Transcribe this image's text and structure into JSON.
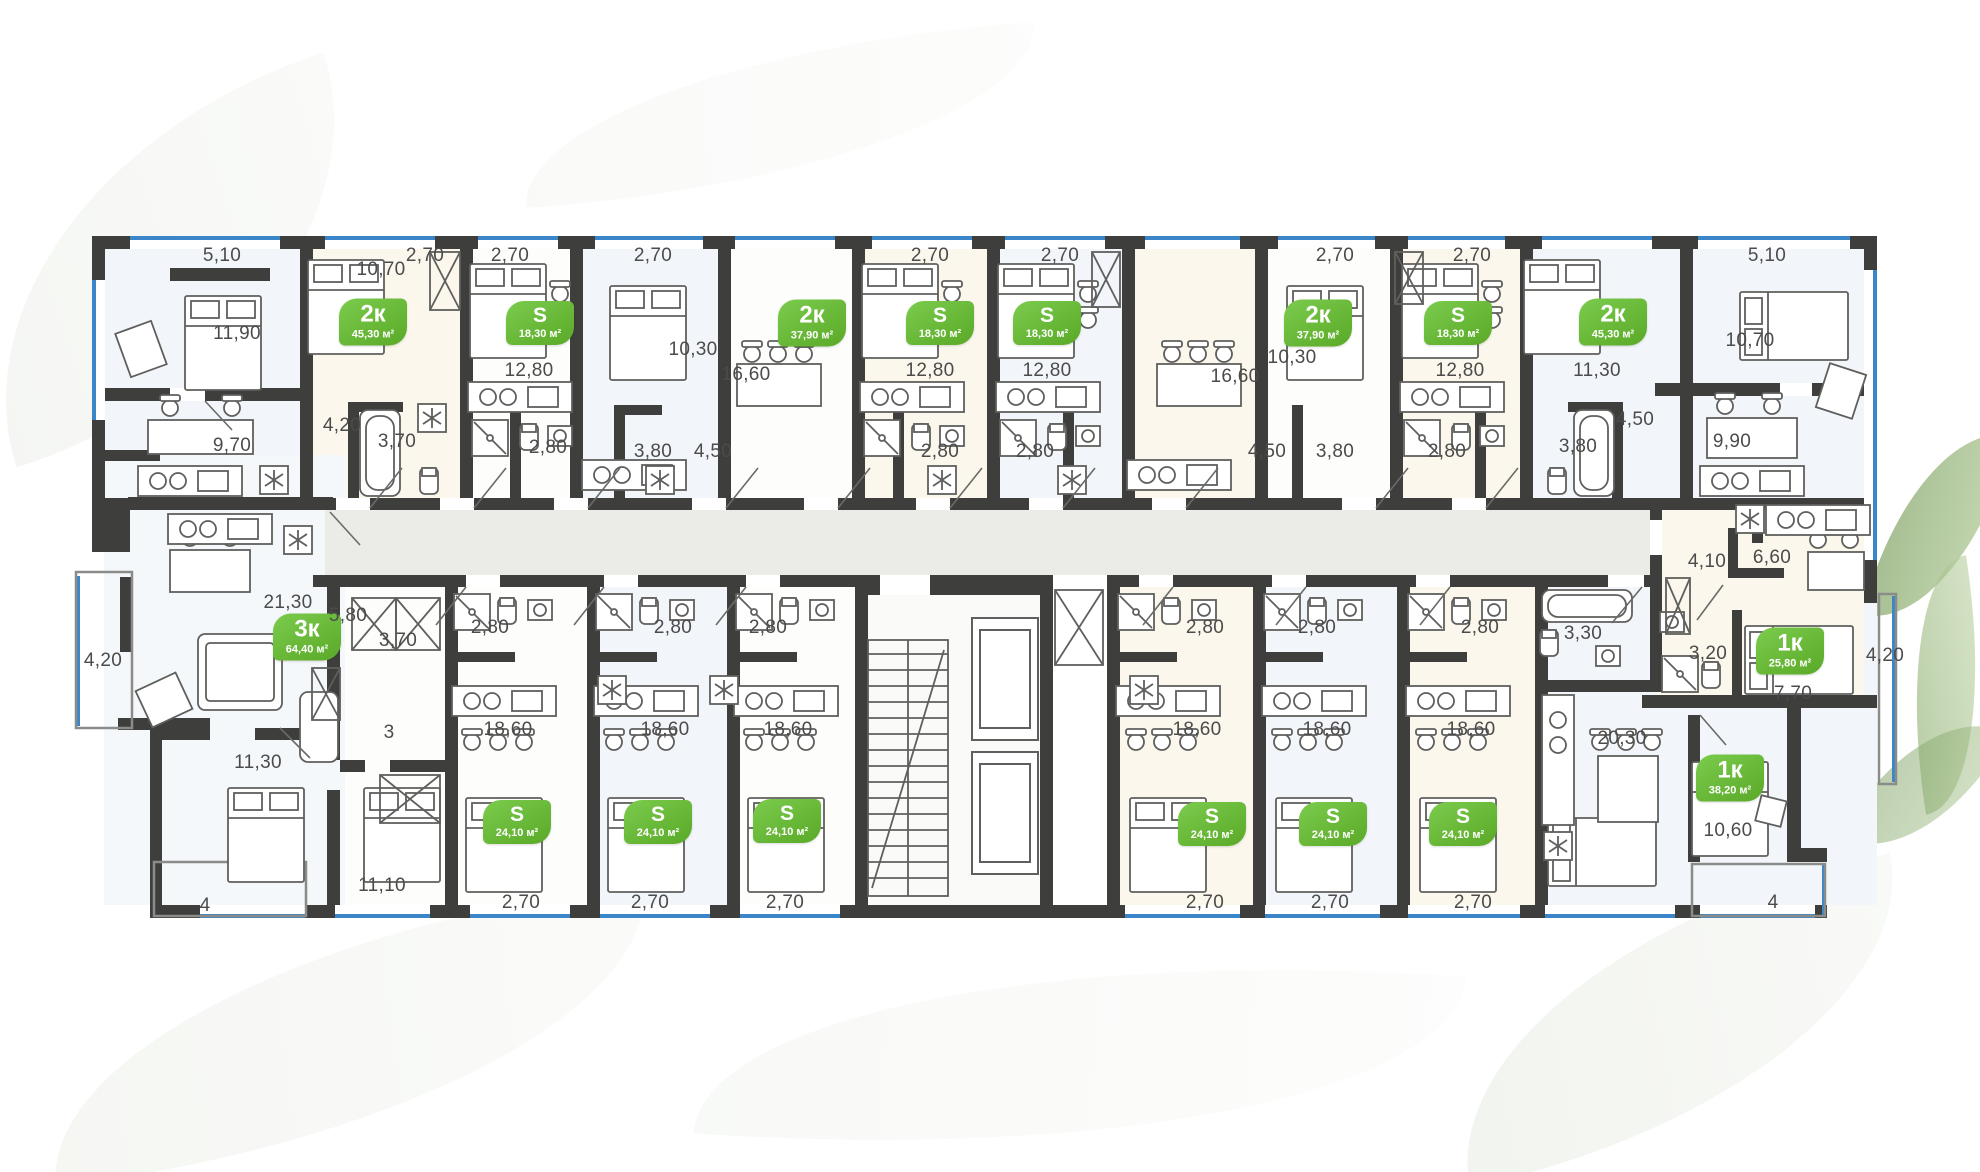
{
  "plan_title": "residential-building-floor-plan",
  "colors": {
    "badge_green": "#66bb39",
    "wall_dark": "#3e3e3c",
    "window_blue": "#3a86c8",
    "corridor_gray": "#ebebe7",
    "dim_text": "#4b4b4b"
  },
  "badges": [
    {
      "type": "2к",
      "area": "45,30 м²",
      "x": 373,
      "y": 322,
      "size": "l"
    },
    {
      "type": "S",
      "area": "18,30 м²",
      "x": 540,
      "y": 323,
      "size": "s"
    },
    {
      "type": "2к",
      "area": "37,90 м²",
      "x": 812,
      "y": 323,
      "size": "l"
    },
    {
      "type": "S",
      "area": "18,30 м²",
      "x": 940,
      "y": 323,
      "size": "s"
    },
    {
      "type": "S",
      "area": "18,30 м²",
      "x": 1047,
      "y": 323,
      "size": "s"
    },
    {
      "type": "2к",
      "area": "37,90 м²",
      "x": 1318,
      "y": 323,
      "size": "l"
    },
    {
      "type": "S",
      "area": "18,30 м²",
      "x": 1458,
      "y": 323,
      "size": "s"
    },
    {
      "type": "2к",
      "area": "45,30 м²",
      "x": 1613,
      "y": 322,
      "size": "l"
    },
    {
      "type": "3к",
      "area": "64,40 м²",
      "x": 307,
      "y": 637,
      "size": "l"
    },
    {
      "type": "1к",
      "area": "25,80 м²",
      "x": 1790,
      "y": 651,
      "size": "l"
    },
    {
      "type": "1к",
      "area": "38,20 м²",
      "x": 1730,
      "y": 778,
      "size": "l"
    },
    {
      "type": "S",
      "area": "24,10 м²",
      "x": 517,
      "y": 822,
      "size": "s"
    },
    {
      "type": "S",
      "area": "24,10 м²",
      "x": 658,
      "y": 822,
      "size": "s"
    },
    {
      "type": "S",
      "area": "24,10 м²",
      "x": 787,
      "y": 821,
      "size": "s"
    },
    {
      "type": "S",
      "area": "24,10 м²",
      "x": 1212,
      "y": 824,
      "size": "s"
    },
    {
      "type": "S",
      "area": "24,10 м²",
      "x": 1333,
      "y": 824,
      "size": "s"
    },
    {
      "type": "S",
      "area": "24,10 м²",
      "x": 1463,
      "y": 824,
      "size": "s"
    }
  ],
  "dimensions": [
    {
      "t": "5,10",
      "x": 222,
      "y": 256
    },
    {
      "t": "2,70",
      "x": 425,
      "y": 256
    },
    {
      "t": "2,70",
      "x": 510,
      "y": 256
    },
    {
      "t": "2,70",
      "x": 653,
      "y": 256
    },
    {
      "t": "2,70",
      "x": 930,
      "y": 256
    },
    {
      "t": "2,70",
      "x": 1060,
      "y": 256
    },
    {
      "t": "2,70",
      "x": 1335,
      "y": 256
    },
    {
      "t": "2,70",
      "x": 1472,
      "y": 256
    },
    {
      "t": "5,10",
      "x": 1767,
      "y": 256
    },
    {
      "t": "10,70",
      "x": 381,
      "y": 270
    },
    {
      "t": "11,90",
      "x": 237,
      "y": 334
    },
    {
      "t": "12,80",
      "x": 529,
      "y": 371
    },
    {
      "t": "10,30",
      "x": 693,
      "y": 350
    },
    {
      "t": "16,60",
      "x": 746,
      "y": 375
    },
    {
      "t": "12,80",
      "x": 930,
      "y": 371
    },
    {
      "t": "12,80",
      "x": 1047,
      "y": 371
    },
    {
      "t": "16,60",
      "x": 1235,
      "y": 377
    },
    {
      "t": "10,30",
      "x": 1292,
      "y": 358
    },
    {
      "t": "12,80",
      "x": 1460,
      "y": 371
    },
    {
      "t": "11,30",
      "x": 1597,
      "y": 371
    },
    {
      "t": "10,70",
      "x": 1750,
      "y": 341
    },
    {
      "t": "4,20",
      "x": 342,
      "y": 426
    },
    {
      "t": "3,70",
      "x": 397,
      "y": 442
    },
    {
      "t": "9,70",
      "x": 232,
      "y": 446
    },
    {
      "t": "2,80",
      "x": 548,
      "y": 448
    },
    {
      "t": "3,80",
      "x": 653,
      "y": 452
    },
    {
      "t": "4,50",
      "x": 713,
      "y": 452
    },
    {
      "t": "2,80",
      "x": 940,
      "y": 452
    },
    {
      "t": "2,80",
      "x": 1035,
      "y": 452
    },
    {
      "t": "4,50",
      "x": 1267,
      "y": 452
    },
    {
      "t": "3,80",
      "x": 1335,
      "y": 452
    },
    {
      "t": "2,80",
      "x": 1447,
      "y": 452
    },
    {
      "t": "4,50",
      "x": 1635,
      "y": 420
    },
    {
      "t": "3,80",
      "x": 1578,
      "y": 447
    },
    {
      "t": "9,90",
      "x": 1732,
      "y": 442
    },
    {
      "t": "21,30",
      "x": 288,
      "y": 603
    },
    {
      "t": "5,80",
      "x": 348,
      "y": 616
    },
    {
      "t": "4,20",
      "x": 103,
      "y": 661
    },
    {
      "t": "3,70",
      "x": 398,
      "y": 641
    },
    {
      "t": "2,80",
      "x": 490,
      "y": 628
    },
    {
      "t": "2,80",
      "x": 673,
      "y": 628
    },
    {
      "t": "2,80",
      "x": 768,
      "y": 628
    },
    {
      "t": "2,80",
      "x": 1205,
      "y": 628
    },
    {
      "t": "2,80",
      "x": 1317,
      "y": 628
    },
    {
      "t": "2,80",
      "x": 1480,
      "y": 628
    },
    {
      "t": "3,30",
      "x": 1583,
      "y": 634
    },
    {
      "t": "3,20",
      "x": 1708,
      "y": 654
    },
    {
      "t": "4,10",
      "x": 1707,
      "y": 562
    },
    {
      "t": "6,60",
      "x": 1772,
      "y": 558
    },
    {
      "t": "7,70",
      "x": 1793,
      "y": 694
    },
    {
      "t": "4,20",
      "x": 1885,
      "y": 656
    },
    {
      "t": "11,30",
      "x": 258,
      "y": 763
    },
    {
      "t": "3",
      "x": 389,
      "y": 733
    },
    {
      "t": "18,60",
      "x": 508,
      "y": 730
    },
    {
      "t": "18,60",
      "x": 665,
      "y": 730
    },
    {
      "t": "18,60",
      "x": 788,
      "y": 730
    },
    {
      "t": "18,60",
      "x": 1197,
      "y": 730
    },
    {
      "t": "18,60",
      "x": 1327,
      "y": 730
    },
    {
      "t": "18,60",
      "x": 1471,
      "y": 730
    },
    {
      "t": "20,30",
      "x": 1622,
      "y": 739
    },
    {
      "t": "10,60",
      "x": 1728,
      "y": 831
    },
    {
      "t": "11,10",
      "x": 382,
      "y": 886
    },
    {
      "t": "4",
      "x": 205,
      "y": 906
    },
    {
      "t": "2,70",
      "x": 521,
      "y": 903
    },
    {
      "t": "2,70",
      "x": 650,
      "y": 903
    },
    {
      "t": "2,70",
      "x": 785,
      "y": 903
    },
    {
      "t": "2,70",
      "x": 1205,
      "y": 903
    },
    {
      "t": "2,70",
      "x": 1330,
      "y": 903
    },
    {
      "t": "2,70",
      "x": 1473,
      "y": 903
    },
    {
      "t": "4",
      "x": 1773,
      "y": 903
    }
  ]
}
